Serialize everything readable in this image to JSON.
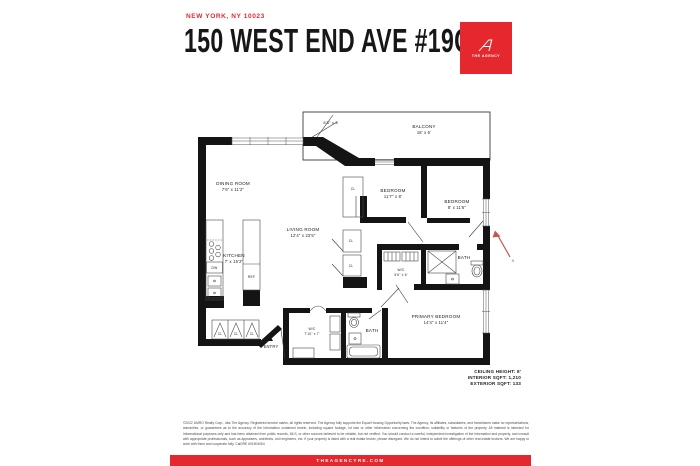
{
  "header": {
    "location": "NEW YORK, NY 10023",
    "title": "150 WEST END AVE #19C",
    "logo": {
      "brand": "THE AGENCY"
    }
  },
  "floorplan": {
    "balcony_name": "BALCONY",
    "balcony_dims": "18' x 6'",
    "terrace_dims": "8'3\" x 3'",
    "dining_name": "DINING ROOM",
    "dining_dims": "7'6\" x 11'2\"",
    "kitchen_name": "KITCHEN",
    "kitchen_dims": "7' x 15'2\"",
    "living_name": "LIVING ROOM",
    "living_dims": "12'4\" x 23'5\"",
    "bedroom2_name": "BEDROOM",
    "bedroom2_dims": "11'7\" x 8'",
    "bedroom3_name": "BEDROOM",
    "bedroom3_dims": "8' x 11'6\"",
    "wic_small_name": "W/C",
    "wic_small_dims": "5'6\" x 6'",
    "bath_upper": "BATH",
    "primary_name": "PRIMARY BEDROOM",
    "primary_dims": "14'4\" x 11'4\"",
    "wic_large_name": "W/C",
    "wic_large_dims": "7'10\" x 7'",
    "bath_lower": "BATH",
    "entry": "ENTRY",
    "closet": "CL",
    "ref": "REF",
    "dw": "DW",
    "north": "N"
  },
  "stats": {
    "ceiling": "CEILING HEIGHT: 8'",
    "interior": "INTERIOR SQFT: 1,210",
    "exterior": "EXTERIOR SQFT: 133"
  },
  "disclaimer": "©2022 UMRO Realty Corp., dba The Agency. Registered service marks, all rights reserved. The Agency fully supports the Equal Housing Opportunity laws. The Agency, its affiliates, subsidiaries, and franchisees make no representations, warranties, or guarantees as to the accuracy of the information contained herein, including square footage, lot size or other information concerning the condition, suitability or features of the property. All material is intended for informational purposes only and has been obtained from public records, MLS, or other sources believed to be reliable, but not verified. You should conduct a careful, independent investigation of the information and property, and consult with appropriate professionals, such as appraisers, architects, civil engineers, etc. If your property is listed with a real estate broker, please disregard. We do not intend to solicit the offerings of other real estate brokers. We are happy to work with them and cooperate fully. CalDRE #01904054",
  "footer": {
    "website": "THEAGENCYRE.COM"
  },
  "colors": {
    "brand_red": "#e4282d",
    "wall_black": "#141414"
  }
}
